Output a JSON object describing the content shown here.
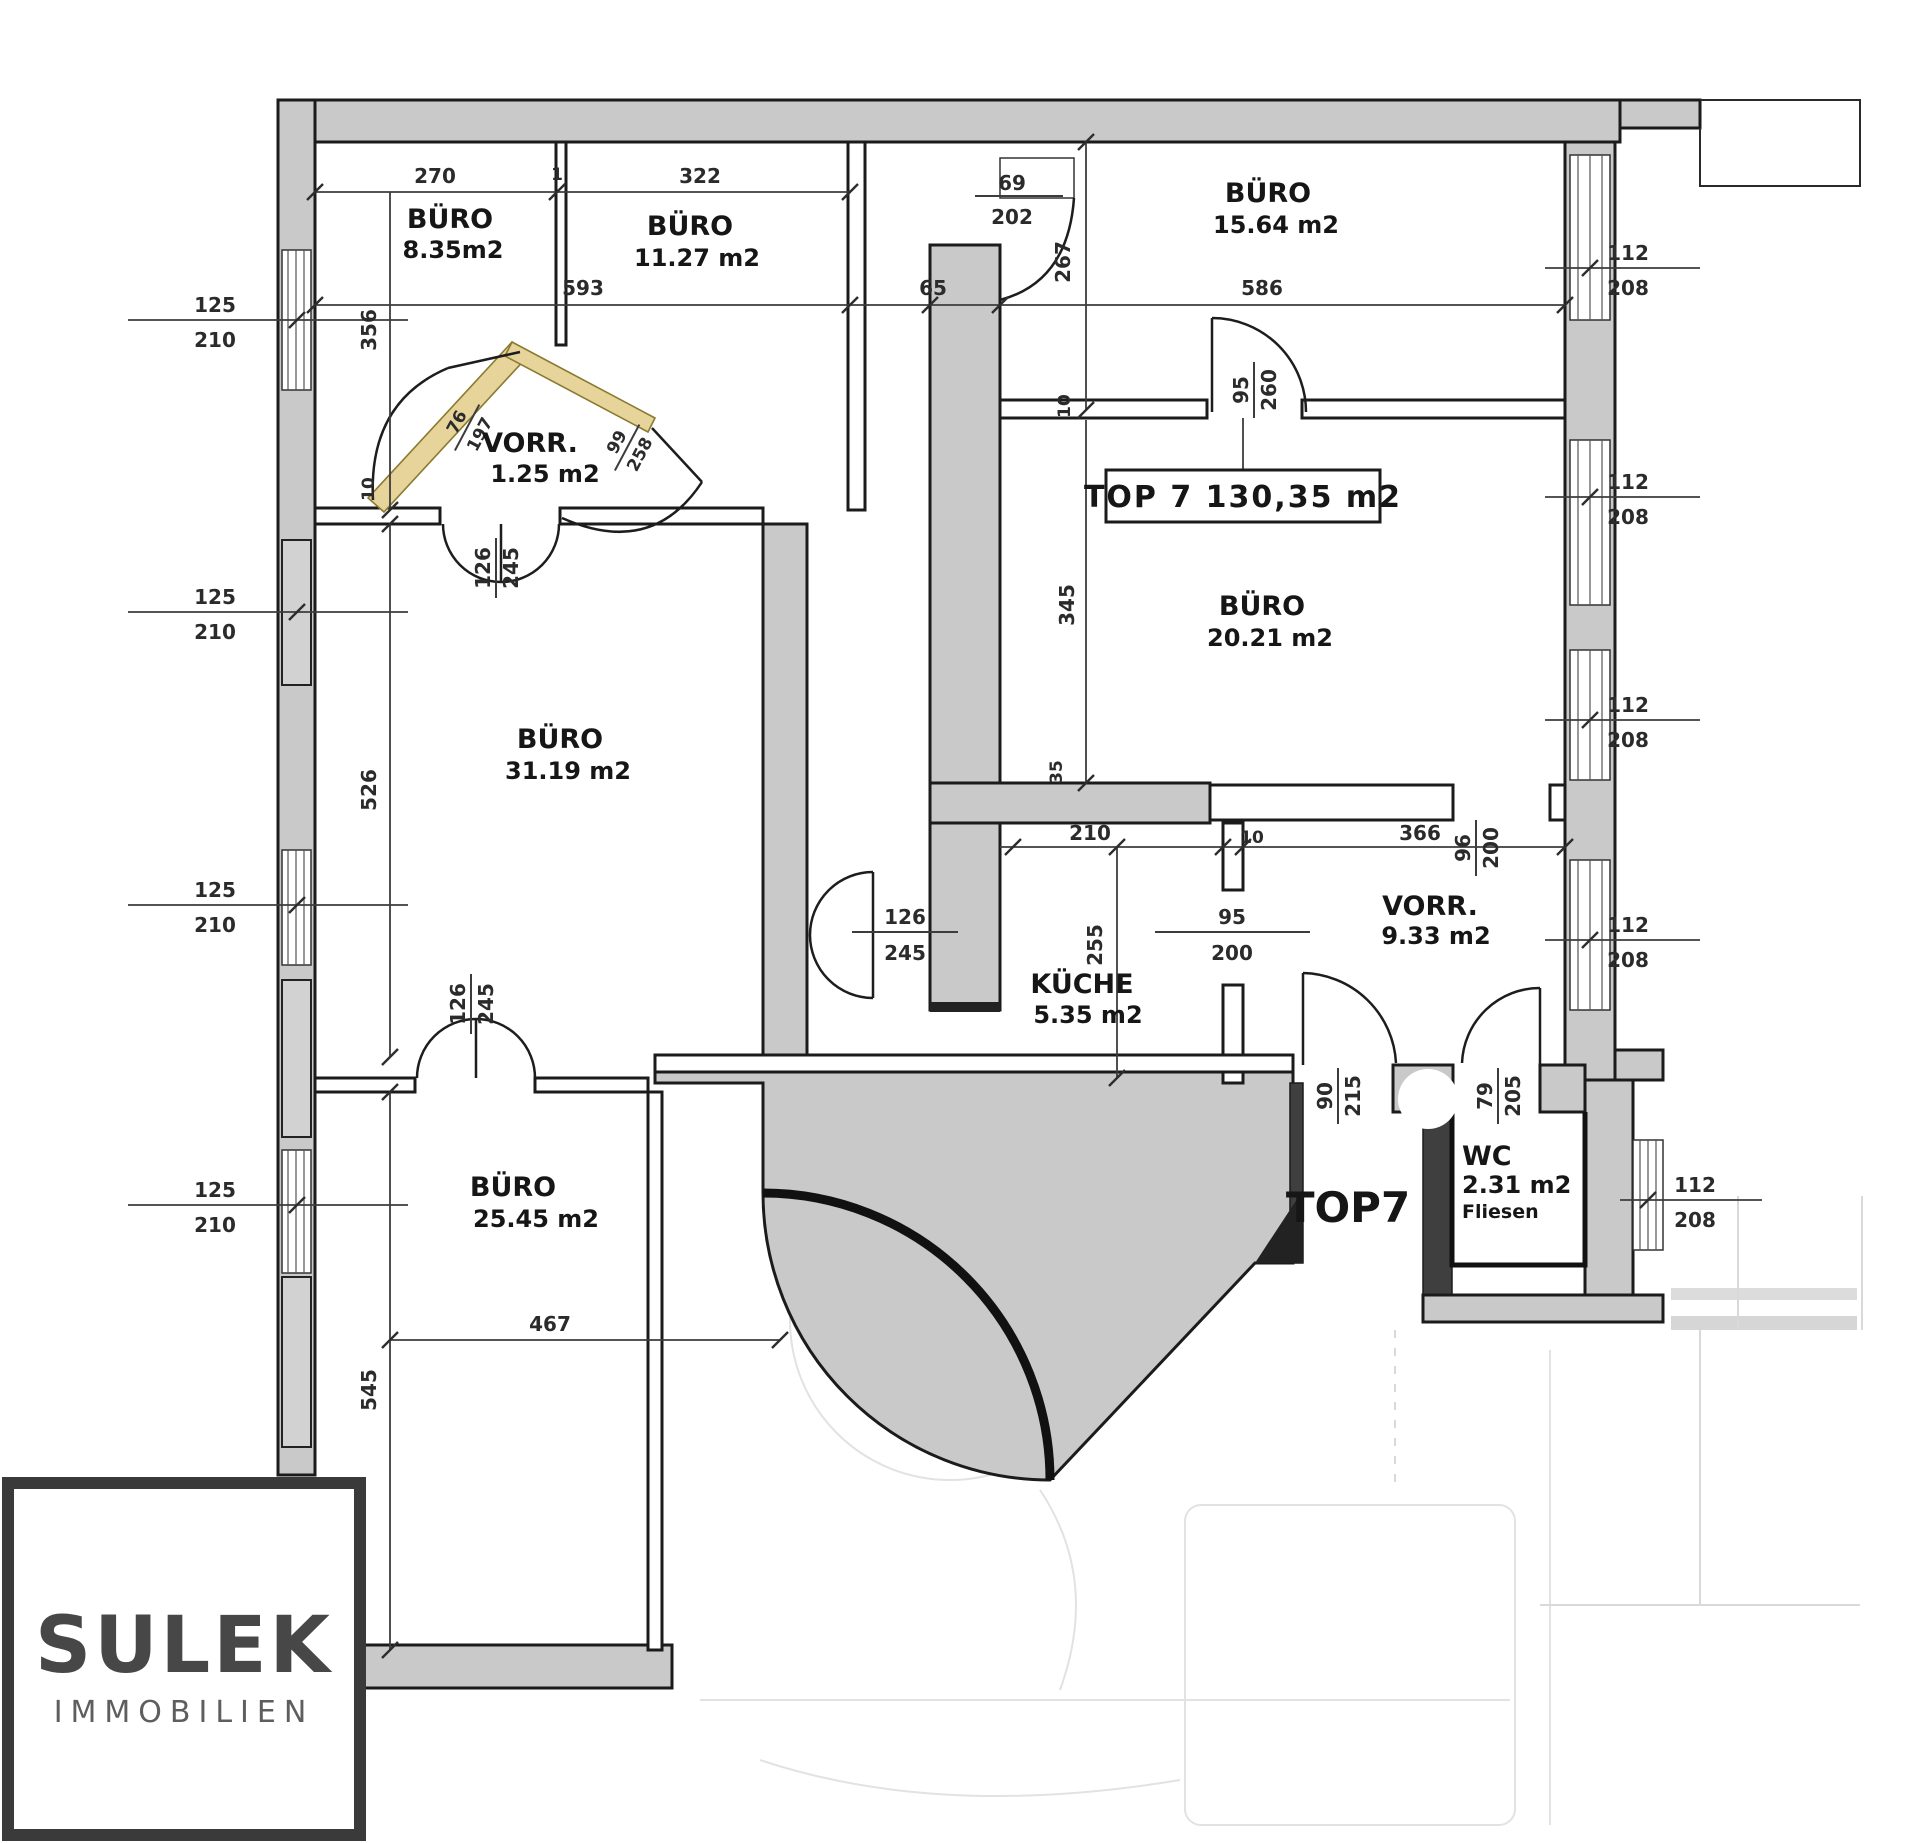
{
  "plan": {
    "unit_box_label": "TOP 7 130,35 m2",
    "entrance_label": "TOP7",
    "rooms": [
      {
        "name": "BÜRO",
        "area": "8.35m2"
      },
      {
        "name": "BÜRO",
        "area": "11.27 m2"
      },
      {
        "name": "BÜRO",
        "area": "15.64 m2"
      },
      {
        "name": "VORR.",
        "area": "1.25 m2"
      },
      {
        "name": "BÜRO",
        "area": "31.19 m2"
      },
      {
        "name": "BÜRO",
        "area": "20.21 m2"
      },
      {
        "name": "KÜCHE",
        "area": "5.35 m2"
      },
      {
        "name": "VORR.",
        "area": "9.33 m2"
      },
      {
        "name": "BÜRO",
        "area": "25.45 m2"
      },
      {
        "name": "WC",
        "area": "2.31 m2",
        "note": "Fliesen"
      }
    ],
    "dims": {
      "n270": "270",
      "n1": "1",
      "n322": "322",
      "n593": "593",
      "n65": "65",
      "n586": "586",
      "n267": "267",
      "n356": "356",
      "n526": "526",
      "n545": "545",
      "n467": "467",
      "n345": "345",
      "n255": "255",
      "n210": "210",
      "n10": "10",
      "n366": "366",
      "n35": "35",
      "win_left_w": "125",
      "win_left_h": "210",
      "win_right_w": "112",
      "win_right_h": "208",
      "d69_w": "69",
      "d69_h": "202",
      "d95a_w": "95",
      "d95a_h": "260",
      "d95b_w": "95",
      "d95b_h": "200",
      "d96_w": "96",
      "d96_h": "200",
      "d126_w": "126",
      "d126_h": "245",
      "d90_w": "90",
      "d90_h": "215",
      "d79_w": "79",
      "d79_h": "205",
      "d76_w": "76",
      "d76_h": "197",
      "d99_w": "99",
      "d99_h": "258"
    }
  },
  "logo": {
    "line1": "SULEK",
    "line2": "IMMOBILIEN"
  },
  "colors": {
    "wall_fill": "#c9c9c9",
    "line": "#1b1b1b",
    "accent_wall": "#e6d49a",
    "dim_line": "#3c3c3c"
  }
}
